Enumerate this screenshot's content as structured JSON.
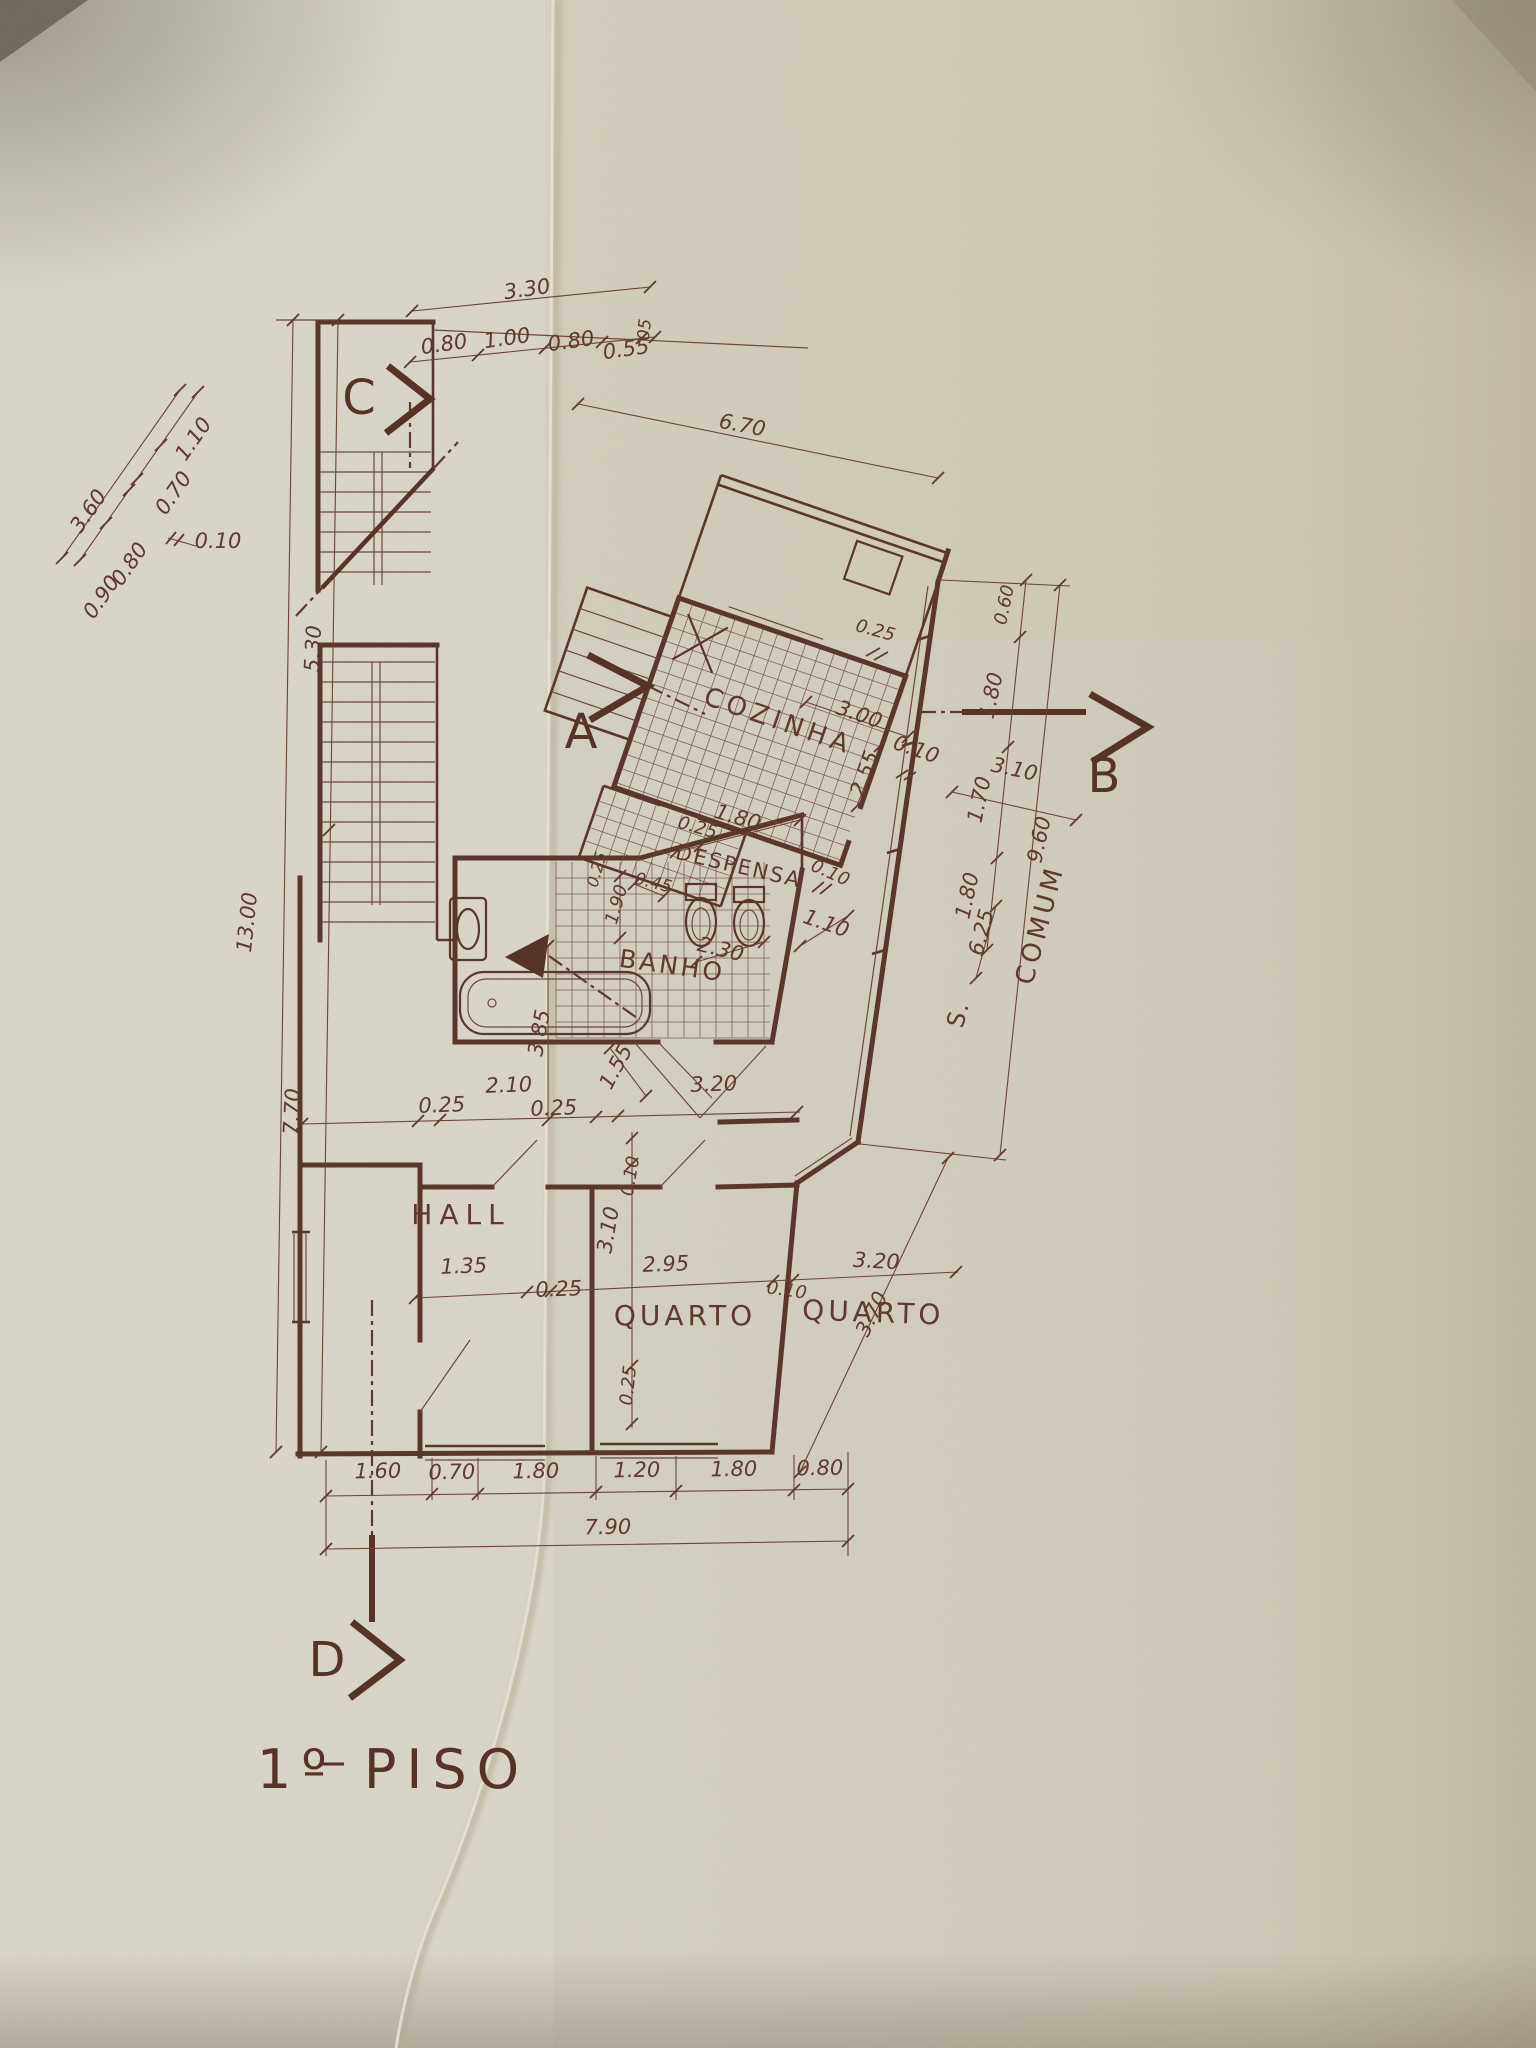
{
  "document": {
    "sheet_title": "1º PISO",
    "drawing_type": "floor plan"
  },
  "title": {
    "text": "1º PISO"
  },
  "colors": {
    "ink": "#59372a",
    "ink_light": "#6a4936",
    "paper_left": "#dcd9cd",
    "paper_right": "#cdc5ae",
    "shadow": "#6f6a5c"
  },
  "section_markers": [
    {
      "letter": "C",
      "x": 359,
      "y": 414
    },
    {
      "letter": "A",
      "x": 581,
      "y": 748
    },
    {
      "letter": "B",
      "x": 1104,
      "y": 792
    },
    {
      "letter": "D",
      "x": 327,
      "y": 1676
    }
  ],
  "rooms": [
    {
      "name": "COZINHA",
      "x": 776,
      "y": 729,
      "rot": 19,
      "fs": 26,
      "ls": 5
    },
    {
      "name": "DESPENSA",
      "x": 737,
      "y": 873,
      "rot": 13,
      "fs": 21,
      "ls": 2
    },
    {
      "name": "BANHO",
      "x": 671,
      "y": 974,
      "rot": 8,
      "fs": 25,
      "ls": 3
    },
    {
      "name": "HALL",
      "x": 461,
      "y": 1224,
      "rot": 0,
      "fs": 28,
      "ls": 7
    },
    {
      "name": "QUARTO",
      "x": 685,
      "y": 1325,
      "rot": 0,
      "fs": 28,
      "ls": 4
    },
    {
      "name": "QUARTO",
      "x": 873,
      "y": 1322,
      "rot": 2,
      "fs": 28,
      "ls": 4
    },
    {
      "name": "S.",
      "x": 966,
      "y": 1016,
      "rot": -75,
      "fs": 24,
      "ls": 2
    },
    {
      "name": "COMUM",
      "x": 1048,
      "y": 927,
      "rot": -75,
      "fs": 26,
      "ls": 4
    }
  ],
  "dimensions": [
    {
      "text": "3.30",
      "x": 528,
      "y": 296,
      "rot": -8
    },
    {
      "text": "0.80",
      "x": 445,
      "y": 351,
      "rot": -8
    },
    {
      "text": "1.00",
      "x": 508,
      "y": 345,
      "rot": -8
    },
    {
      "text": "0.80",
      "x": 572,
      "y": 348,
      "rot": -8
    },
    {
      "text": "0.55",
      "x": 627,
      "y": 356,
      "rot": -8
    },
    {
      "text": "05",
      "x": 650,
      "y": 330,
      "rot": -85,
      "fs": 17
    },
    {
      "text": "1.10",
      "x": 199,
      "y": 443,
      "rot": -55
    },
    {
      "text": "0.70",
      "x": 179,
      "y": 497,
      "rot": -55
    },
    {
      "text": "0.10",
      "x": 218,
      "y": 548,
      "rot": 0
    },
    {
      "text": "0.80",
      "x": 135,
      "y": 568,
      "rot": -55
    },
    {
      "text": "0.90",
      "x": 107,
      "y": 601,
      "rot": -55
    },
    {
      "text": "3.60",
      "x": 94,
      "y": 515,
      "rot": -55
    },
    {
      "text": "5.30",
      "x": 320,
      "y": 649,
      "rot": -87
    },
    {
      "text": "13.00",
      "x": 254,
      "y": 923,
      "rot": -84
    },
    {
      "text": "7.70",
      "x": 299,
      "y": 1112,
      "rot": -87
    },
    {
      "text": "6.70",
      "x": 741,
      "y": 432,
      "rot": 11
    },
    {
      "text": "3.00",
      "x": 857,
      "y": 721,
      "rot": 19
    },
    {
      "text": "2.55",
      "x": 871,
      "y": 776,
      "rot": -70
    },
    {
      "text": "0.10",
      "x": 914,
      "y": 756,
      "rot": 19
    },
    {
      "text": "3.10",
      "x": 1013,
      "y": 776,
      "rot": 12
    },
    {
      "text": "0.25",
      "x": 696,
      "y": 833,
      "rot": 16,
      "fs": 18
    },
    {
      "text": "1.80",
      "x": 736,
      "y": 824,
      "rot": 16
    },
    {
      "text": "0.10",
      "x": 828,
      "y": 878,
      "rot": 24,
      "fs": 18
    },
    {
      "text": "0.45",
      "x": 652,
      "y": 888,
      "rot": 14,
      "fs": 17
    },
    {
      "text": "0.25",
      "x": 602,
      "y": 871,
      "rot": -74,
      "fs": 16
    },
    {
      "text": "1.90",
      "x": 622,
      "y": 906,
      "rot": -74,
      "fs": 18
    },
    {
      "text": "2.30",
      "x": 719,
      "y": 956,
      "rot": 14
    },
    {
      "text": "1.10",
      "x": 824,
      "y": 930,
      "rot": 19
    },
    {
      "text": "6.25",
      "x": 988,
      "y": 934,
      "rot": -75
    },
    {
      "text": "0.60",
      "x": 1010,
      "y": 606,
      "rot": -78,
      "fs": 18
    },
    {
      "text": "1.80",
      "x": 998,
      "y": 697,
      "rot": -78
    },
    {
      "text": "1.70",
      "x": 986,
      "y": 801,
      "rot": -78
    },
    {
      "text": "1.80",
      "x": 974,
      "y": 897,
      "rot": -78
    },
    {
      "text": "9.60",
      "x": 1046,
      "y": 841,
      "rot": -78
    },
    {
      "text": "0.25",
      "x": 874,
      "y": 636,
      "rot": 15,
      "fs": 18
    },
    {
      "text": "3.85",
      "x": 546,
      "y": 1034,
      "rot": -80
    },
    {
      "text": "1.55",
      "x": 622,
      "y": 1070,
      "rot": -62
    },
    {
      "text": "2.10",
      "x": 509,
      "y": 1092,
      "rot": -2
    },
    {
      "text": "0.25",
      "x": 442,
      "y": 1112,
      "rot": -2
    },
    {
      "text": "0.25",
      "x": 554,
      "y": 1115,
      "rot": -2
    },
    {
      "text": "3.20",
      "x": 714,
      "y": 1091,
      "rot": -2
    },
    {
      "text": "3.70",
      "x": 878,
      "y": 1317,
      "rot": -64
    },
    {
      "text": "1.35",
      "x": 464,
      "y": 1273,
      "rot": -2
    },
    {
      "text": "0.25",
      "x": 559,
      "y": 1296,
      "rot": -2
    },
    {
      "text": "3.10",
      "x": 615,
      "y": 1231,
      "rot": -80
    },
    {
      "text": "0.10",
      "x": 636,
      "y": 1177,
      "rot": -80,
      "fs": 18
    },
    {
      "text": "2.95",
      "x": 666,
      "y": 1271,
      "rot": -2
    },
    {
      "text": "0.10",
      "x": 786,
      "y": 1296,
      "rot": 8,
      "fs": 18
    },
    {
      "text": "3.20",
      "x": 876,
      "y": 1268,
      "rot": 3
    },
    {
      "text": "0.25",
      "x": 634,
      "y": 1386,
      "rot": -84,
      "fs": 18
    },
    {
      "text": "1.60",
      "x": 378,
      "y": 1478,
      "rot": -1
    },
    {
      "text": "0.70",
      "x": 452,
      "y": 1479,
      "rot": -1
    },
    {
      "text": "1.80",
      "x": 536,
      "y": 1478,
      "rot": -1
    },
    {
      "text": "1.20",
      "x": 637,
      "y": 1477,
      "rot": -1
    },
    {
      "text": "1.80",
      "x": 734,
      "y": 1476,
      "rot": -1
    },
    {
      "text": "0.80",
      "x": 820,
      "y": 1475,
      "rot": -1
    },
    {
      "text": "7.90",
      "x": 608,
      "y": 1534,
      "rot": -1
    }
  ]
}
